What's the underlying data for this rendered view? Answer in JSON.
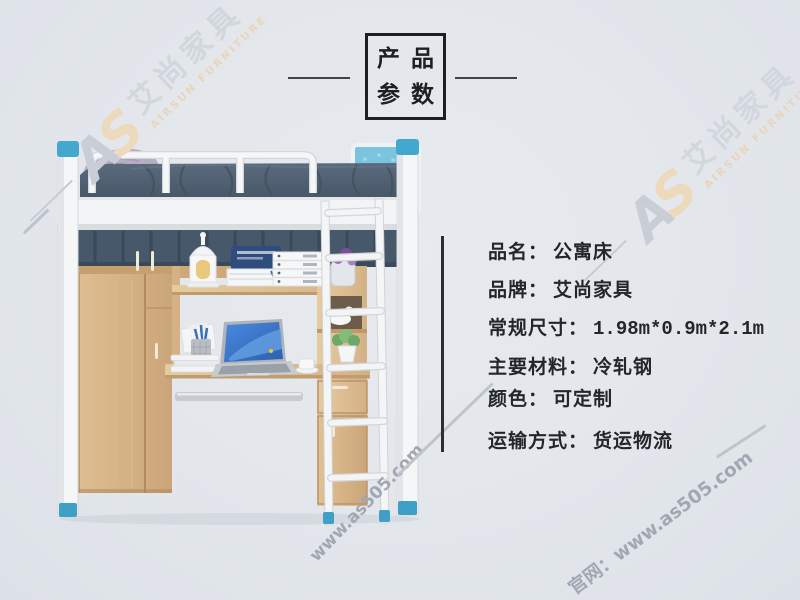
{
  "header": {
    "title_line1": "产品",
    "title_line2": "参数"
  },
  "specs": {
    "items": [
      {
        "label": "品名：",
        "value": "公寓床"
      },
      {
        "label": "品牌：",
        "value": "艾尚家具"
      },
      {
        "label": "常规尺寸：",
        "value": "1.98m*0.9m*2.1m"
      },
      {
        "label": "主要材料：",
        "value": "冷轧钢"
      },
      {
        "label": "颜色：",
        "value": "可定制"
      },
      {
        "label": "运输方式：",
        "value": "货运物流"
      }
    ]
  },
  "watermarks": {
    "logo_a": "A",
    "logo_s": "S",
    "brand_cn": "艾尚家具",
    "brand_en": "AIRSUN FURNITURE",
    "url_plain": "www.as505.com",
    "url_labeled": "官网：www.as505.com"
  },
  "colors": {
    "background": "#e3e7ec",
    "text": "#23272b",
    "steel_blue_caps": "#42a8cd",
    "wood": "#d7b488",
    "bedding": "#516173",
    "headboard_blue": "#7cc4de",
    "watermark_gray": "#d2d6dd",
    "watermark_tan": "#e8d5ba",
    "watermark_url_gray": "#a2a8b2"
  }
}
